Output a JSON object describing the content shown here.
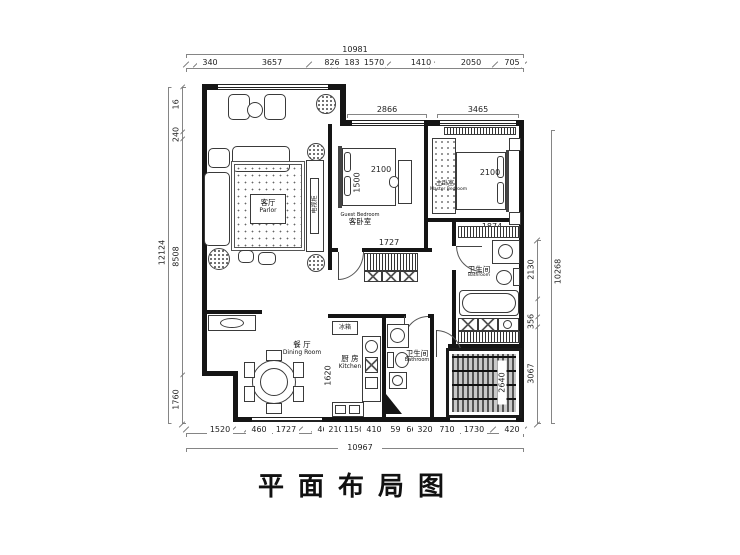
{
  "title": "平面布局图",
  "dimensions": {
    "top": {
      "total": "10981",
      "segments": [
        "340",
        "3657",
        "826",
        "183",
        "1570",
        "1410",
        "2050",
        "705"
      ],
      "windows": [
        "2866",
        "3465"
      ]
    },
    "bottom": {
      "total": "10967",
      "segments": [
        "1520",
        "460",
        "1727",
        "460",
        "210",
        "1150",
        "410",
        "590",
        "660",
        "320",
        "710",
        "1730",
        "420"
      ]
    },
    "left": {
      "total": "12124",
      "segments": [
        "1616",
        "240",
        "8508",
        "1760"
      ]
    },
    "right": {
      "total": "10268",
      "segments": [
        "2130",
        "650",
        "356",
        "3067"
      ]
    }
  },
  "rooms": {
    "parlor": {
      "zh": "客厅",
      "en": "Parlor"
    },
    "guest_bedroom": {
      "zh": "客卧室",
      "en": "Guest Bedroom"
    },
    "master_bedroom": {
      "zh": "主卧室",
      "en": "Master Bedroom"
    },
    "dining_room": {
      "zh": "餐 厅",
      "en": "Dining Room"
    },
    "kitchen": {
      "zh": "厨 房",
      "en": "Kitchen"
    },
    "bathroom_master": {
      "zh": "卫生间",
      "en": "Bathroom"
    },
    "bathroom_common": {
      "zh": "卫生间",
      "en": "Bathroom"
    }
  },
  "furniture_dims": {
    "guest_bed_width": "2100",
    "guest_bed_depth": "1500",
    "hall_wardrobe": "1727",
    "master_bed_width": "2100",
    "master_bed_side": "1874",
    "kitchen_width": "1620",
    "tatami_width": "2640"
  },
  "appliances": {
    "fridge": "冰箱",
    "tv_cabinet": "电视柜"
  }
}
